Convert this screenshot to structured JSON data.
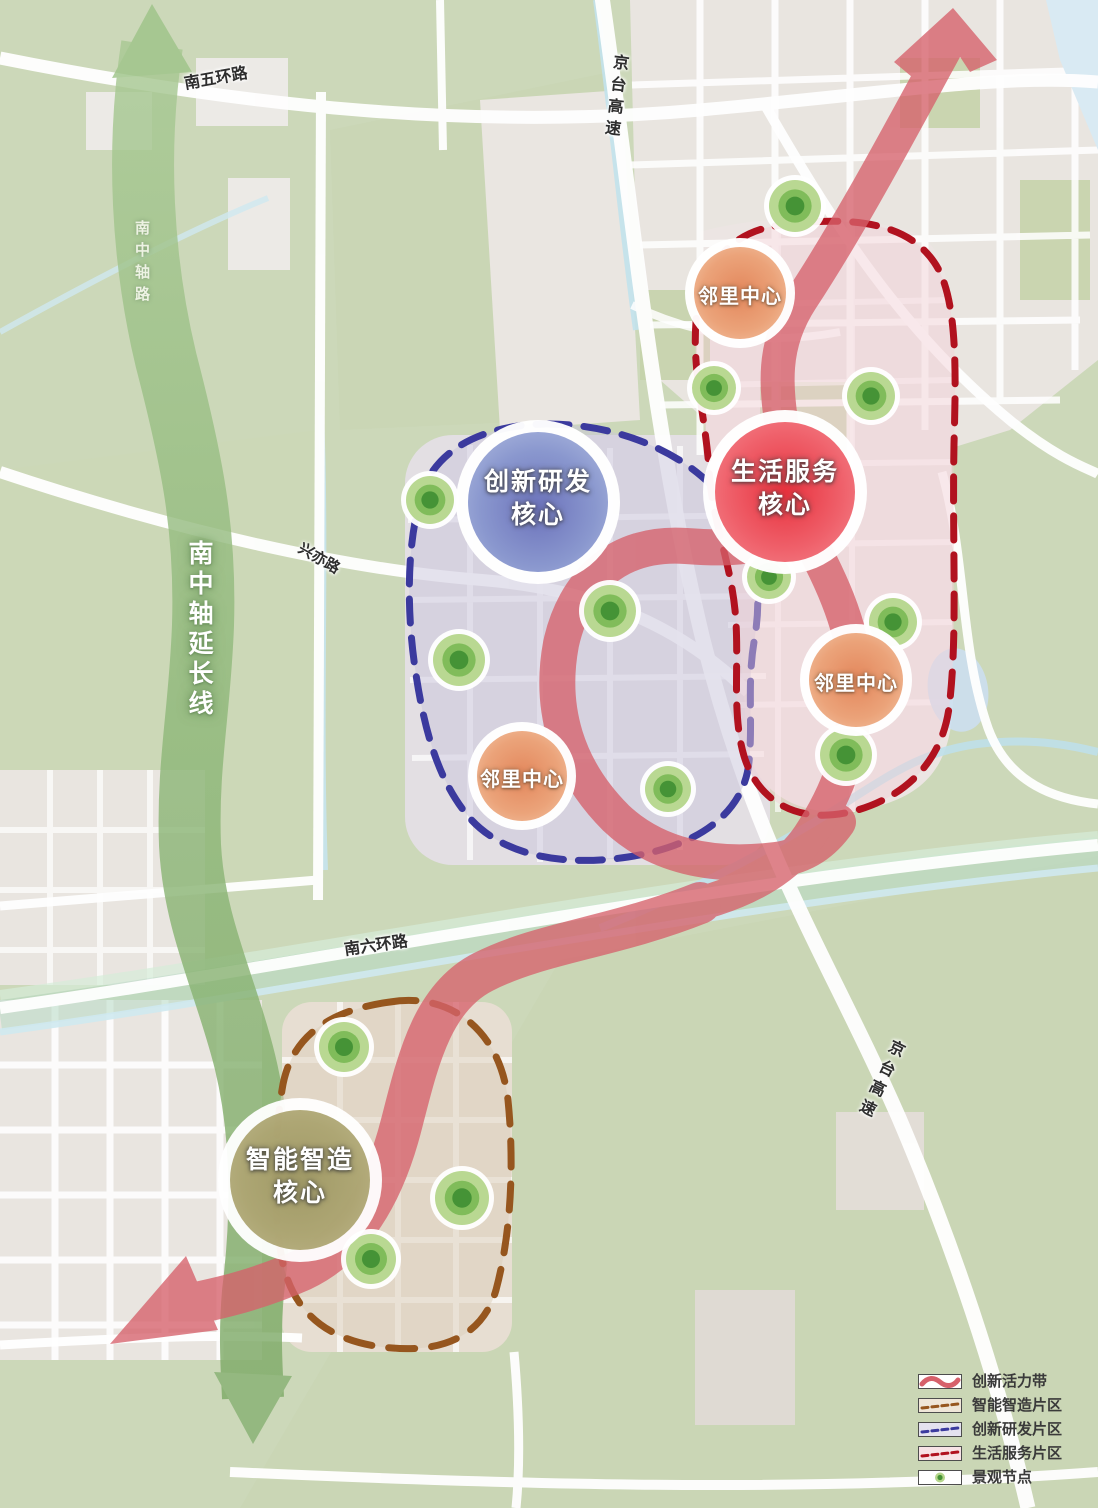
{
  "colors": {
    "vitality_band": "#d6616b",
    "manufacturing_zone": "#96561e",
    "innovation_zone": "#3b3a9e",
    "life_service_zone": "#b1121f",
    "landscape_node_green": "#459336",
    "axis_green": "#8fb87a",
    "legend_text": "#3a3a3a"
  },
  "roads": {
    "south_5th_ring": "南五环路",
    "jingtai_expressway_top": "京台高速",
    "nanzhongzhou_road": "南中轴路",
    "xingyi_road": "兴亦路",
    "south_6th_ring": "南六环路",
    "jingtai_expressway_bottom": "京台高速"
  },
  "axis": {
    "label": "南中轴延长线"
  },
  "cores": [
    {
      "id": "innovation-rd-core",
      "label": "创新研发\n核心"
    },
    {
      "id": "life-service-core",
      "label": "生活服务\n核心"
    },
    {
      "id": "smart-manufacturing-core",
      "label": "智能智造\n核心"
    }
  ],
  "neighborhood_centers": [
    {
      "label": "邻里中心"
    },
    {
      "label": "邻里中心"
    },
    {
      "label": "邻里中心"
    }
  ],
  "landscape_nodes": {
    "points": [
      [
        795,
        206,
        26
      ],
      [
        714,
        388,
        22
      ],
      [
        871,
        396,
        24
      ],
      [
        430,
        500,
        24
      ],
      [
        610,
        611,
        26
      ],
      [
        459,
        660,
        26
      ],
      [
        769,
        577,
        22
      ],
      [
        893,
        622,
        24
      ],
      [
        846,
        755,
        26
      ],
      [
        668,
        789,
        23
      ],
      [
        344,
        1047,
        25
      ],
      [
        462,
        1198,
        27
      ],
      [
        371,
        1259,
        25
      ]
    ]
  },
  "legend": {
    "items": [
      {
        "label": "创新活力带",
        "type": "band"
      },
      {
        "label": "智能智造片区",
        "type": "zone-brown"
      },
      {
        "label": "创新研发片区",
        "type": "zone-blue"
      },
      {
        "label": "生活服务片区",
        "type": "zone-red"
      },
      {
        "label": "景观节点",
        "type": "node"
      }
    ]
  }
}
